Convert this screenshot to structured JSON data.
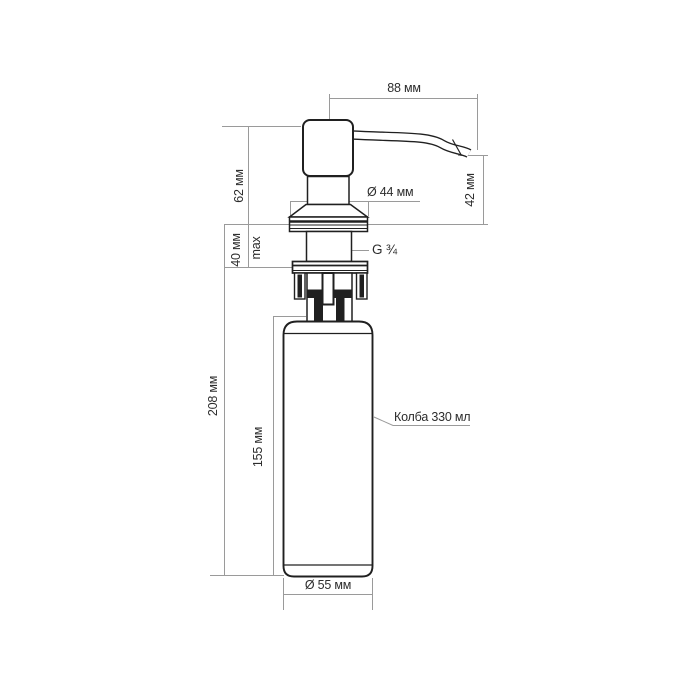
{
  "drawing": {
    "type": "technical-dimension-drawing",
    "subject": "kitchen soap dispenser",
    "labels": {
      "spout_length": "88 мм",
      "spout_drop_height": "42 мм",
      "head_height": "62 мм",
      "flange_diameter": "Ø 44 мм",
      "mount_thickness": "40 мм",
      "mount_thickness_note": "max",
      "thread_size": "G ¾",
      "under_counter_depth": "208 мм",
      "flask_height": "155 мм",
      "flask_volume_note": "Колба 330 мл",
      "flask_diameter": "Ø 55 мм"
    },
    "colors": {
      "background": "#ffffff",
      "outline": "#202020",
      "dimension_line": "#9a9a9a",
      "label_text": "#2d2d2d"
    }
  }
}
